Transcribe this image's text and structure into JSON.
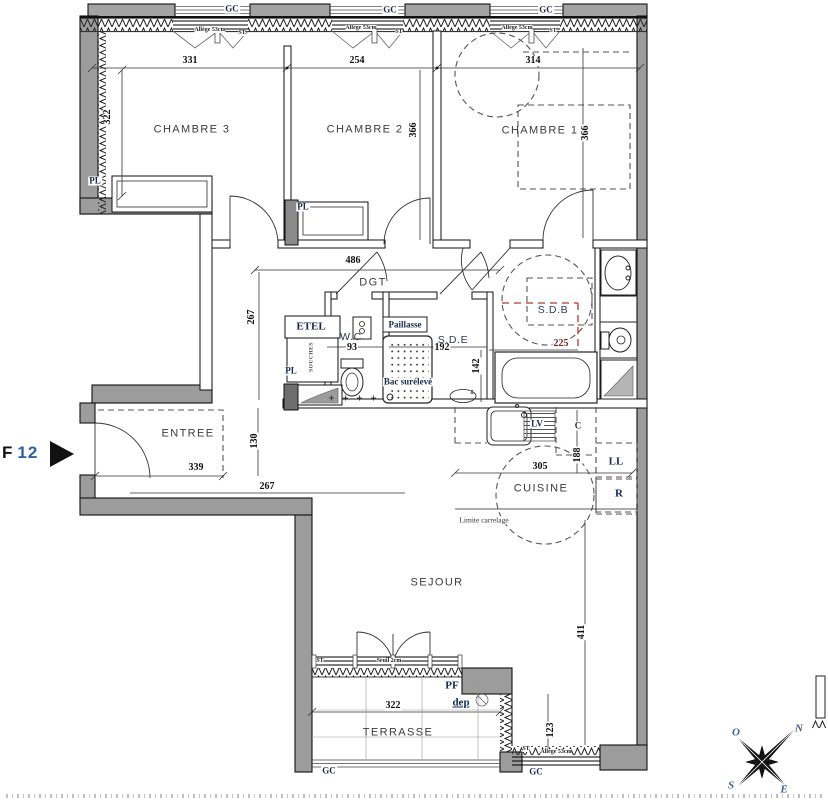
{
  "colors": {
    "wall_gray": "#9c9c9c",
    "cap_gray": "#a3a3a3",
    "red_accent": "#b03a2e",
    "label_navy": "#17294f",
    "flat_number_blue": "#2e5fa3"
  },
  "flat": {
    "prefix": "F",
    "number": "12"
  },
  "labels": {
    "rooms": [
      {
        "name": "room-label-chambre-3",
        "text": "CHAMBRE 3",
        "x": 192,
        "y": 130,
        "cls": "room"
      },
      {
        "name": "room-label-chambre-2",
        "text": "CHAMBRE 2",
        "x": 365,
        "y": 130,
        "cls": "room"
      },
      {
        "name": "room-label-chambre-1",
        "text": "CHAMBRE 1",
        "x": 540,
        "y": 131,
        "cls": "room"
      },
      {
        "name": "room-label-dgt",
        "text": "DGT",
        "x": 373,
        "y": 283,
        "cls": "room"
      },
      {
        "name": "room-label-entree",
        "text": "ENTREE",
        "x": 188,
        "y": 434,
        "cls": "room"
      },
      {
        "name": "room-label-wc",
        "text": "W.C",
        "x": 351,
        "y": 337,
        "cls": "room-sm"
      },
      {
        "name": "room-label-sde",
        "text": "S.D.E",
        "x": 453,
        "y": 340,
        "cls": "room-sm"
      },
      {
        "name": "room-label-sdb",
        "text": "S.D.B",
        "x": 553,
        "y": 310,
        "cls": "room-sm navy"
      },
      {
        "name": "room-label-cuisine",
        "text": "CUISINE",
        "x": 541,
        "y": 489,
        "cls": "room"
      },
      {
        "name": "room-label-sejour",
        "text": "SEJOUR",
        "x": 437,
        "y": 583,
        "cls": "room"
      },
      {
        "name": "room-label-terrasse",
        "text": "TERRASSE",
        "x": 398,
        "y": 733,
        "cls": "room"
      }
    ],
    "dimensions": [
      {
        "name": "dim-331",
        "text": "331",
        "x": 190,
        "y": 61,
        "cls": "dim"
      },
      {
        "name": "dim-322-left",
        "text": "322",
        "x": 108,
        "y": 117,
        "cls": "dim",
        "rot": -90
      },
      {
        "name": "dim-254",
        "text": "254",
        "x": 357,
        "y": 61,
        "cls": "dim"
      },
      {
        "name": "dim-366-ch2",
        "text": "366",
        "x": 414,
        "y": 130,
        "cls": "dim",
        "rot": -90
      },
      {
        "name": "dim-314",
        "text": "314",
        "x": 533,
        "y": 61,
        "cls": "dim"
      },
      {
        "name": "dim-366-ch1",
        "text": "366",
        "x": 586,
        "y": 133,
        "cls": "dim",
        "rot": -90
      },
      {
        "name": "dim-486",
        "text": "486",
        "x": 353,
        "y": 261,
        "cls": "dim"
      },
      {
        "name": "dim-267-hall",
        "text": "267",
        "x": 252,
        "y": 317,
        "cls": "dim",
        "rot": -90
      },
      {
        "name": "dim-93",
        "text": "93",
        "x": 352,
        "y": 348,
        "cls": "dim"
      },
      {
        "name": "dim-192",
        "text": "192",
        "x": 442,
        "y": 348,
        "cls": "dim"
      },
      {
        "name": "dim-142",
        "text": "142",
        "x": 477,
        "y": 366,
        "cls": "dim",
        "rot": -90
      },
      {
        "name": "dim-225",
        "text": "225",
        "x": 561,
        "y": 344,
        "cls": "dim redtxt"
      },
      {
        "name": "dim-339",
        "text": "339",
        "x": 196,
        "y": 468,
        "cls": "dim"
      },
      {
        "name": "dim-130",
        "text": "130",
        "x": 255,
        "y": 441,
        "cls": "dim",
        "rot": -90
      },
      {
        "name": "dim-267-entree",
        "text": "267",
        "x": 267,
        "y": 487,
        "cls": "dim"
      },
      {
        "name": "dim-305",
        "text": "305",
        "x": 540,
        "y": 467,
        "cls": "dim"
      },
      {
        "name": "dim-188",
        "text": "188",
        "x": 578,
        "y": 455,
        "cls": "dim",
        "rot": -90
      },
      {
        "name": "dim-411",
        "text": "411",
        "x": 582,
        "y": 632,
        "cls": "dim",
        "rot": -90
      },
      {
        "name": "dim-322-terrasse",
        "text": "322",
        "x": 393,
        "y": 706,
        "cls": "dim"
      },
      {
        "name": "dim-123",
        "text": "123",
        "x": 551,
        "y": 730,
        "cls": "dim",
        "rot": -90
      },
      {
        "name": "dim-8",
        "text": "8",
        "x": 472,
        "y": 393,
        "cls": "tiny"
      }
    ],
    "tags": [
      {
        "name": "gc-label-1",
        "text": "GC",
        "x": 232,
        "y": 9,
        "cls": "tag"
      },
      {
        "name": "gc-label-2",
        "text": "GC",
        "x": 390,
        "y": 10,
        "cls": "tag"
      },
      {
        "name": "gc-label-3",
        "text": "GC",
        "x": 546,
        "y": 10,
        "cls": "tag"
      },
      {
        "name": "gc-label-terrasse",
        "text": "GC",
        "x": 329,
        "y": 771,
        "cls": "tag"
      },
      {
        "name": "gc-label-nook",
        "text": "GC",
        "x": 536,
        "y": 772,
        "cls": "tag"
      },
      {
        "name": "pl-label-ch3",
        "text": "PL",
        "x": 95,
        "y": 181,
        "cls": "tag"
      },
      {
        "name": "pl-label-ch2",
        "text": "PL",
        "x": 303,
        "y": 207,
        "cls": "tag"
      },
      {
        "name": "pl-label-hall",
        "text": "PL",
        "x": 291,
        "y": 371,
        "cls": "tag"
      },
      {
        "name": "etel-label",
        "text": "ETEL",
        "x": 311,
        "y": 327,
        "cls": "tag-lg"
      },
      {
        "name": "shaft-label",
        "text": "SOUCHES",
        "x": 312,
        "y": 357,
        "cls": "vtxt",
        "rot": -90
      },
      {
        "name": "paillasse-label",
        "text": "Paillasse",
        "x": 405,
        "y": 325,
        "cls": "tag"
      },
      {
        "name": "bac-sureleve-label",
        "text": "Bac surélevé",
        "x": 408,
        "y": 382,
        "cls": "tag"
      },
      {
        "name": "lv-label",
        "text": "LV",
        "x": 537,
        "y": 424,
        "cls": "tag"
      },
      {
        "name": "c-label",
        "text": "C",
        "x": 578,
        "y": 426,
        "cls": "tag"
      },
      {
        "name": "ll-label",
        "text": "LL",
        "x": 616,
        "y": 462,
        "cls": "tag-lg"
      },
      {
        "name": "r-label",
        "text": "R",
        "x": 619,
        "y": 494,
        "cls": "tag-lg"
      },
      {
        "name": "pf-label",
        "text": "PF",
        "x": 452,
        "y": 686,
        "cls": "tag-lg"
      },
      {
        "name": "dep-label",
        "text": "dep",
        "x": 461,
        "y": 703,
        "cls": "tag-lg underline"
      }
    ],
    "window_notes": [
      {
        "name": "st-label-ch3",
        "text": "ST",
        "x": 242,
        "y": 33,
        "cls": "tiny"
      },
      {
        "name": "st-label-ch2",
        "text": "ST",
        "x": 399,
        "y": 32,
        "cls": "tiny"
      },
      {
        "name": "st-label-ch1",
        "text": "ST",
        "x": 553,
        "y": 31,
        "cls": "tiny"
      },
      {
        "name": "st-label-sejour",
        "text": "ST",
        "x": 320,
        "y": 661,
        "cls": "tiny"
      },
      {
        "name": "st-label-nook",
        "text": "ST",
        "x": 526,
        "y": 749,
        "cls": "tiny"
      },
      {
        "name": "allege-label-ch3",
        "text": "Allège 53cm",
        "x": 210,
        "y": 30,
        "cls": "tiny"
      },
      {
        "name": "allege-label-ch2",
        "text": "Allège 53cm",
        "x": 361,
        "y": 28,
        "cls": "tiny"
      },
      {
        "name": "allege-label-ch1",
        "text": "Allège 53cm",
        "x": 517,
        "y": 28,
        "cls": "tiny"
      },
      {
        "name": "allege-label-nook",
        "text": "Allège 53cm",
        "x": 556,
        "y": 752,
        "cls": "tiny"
      },
      {
        "name": "seuil-label",
        "text": "Seuil 2cm",
        "x": 389,
        "y": 661,
        "cls": "tiny"
      },
      {
        "name": "limite-carrelage-label",
        "text": "Limite carrelage",
        "x": 484,
        "y": 520,
        "cls": "lim"
      }
    ],
    "compass": [
      {
        "name": "compass-n",
        "text": "N",
        "x": 799,
        "y": 729,
        "cls": "compass"
      },
      {
        "name": "compass-o",
        "text": "O",
        "x": 736,
        "y": 733,
        "cls": "compass"
      },
      {
        "name": "compass-s",
        "text": "S",
        "x": 731,
        "y": 786,
        "cls": "compass"
      },
      {
        "name": "compass-e",
        "text": "E",
        "x": 784,
        "y": 790,
        "cls": "compass"
      }
    ]
  }
}
